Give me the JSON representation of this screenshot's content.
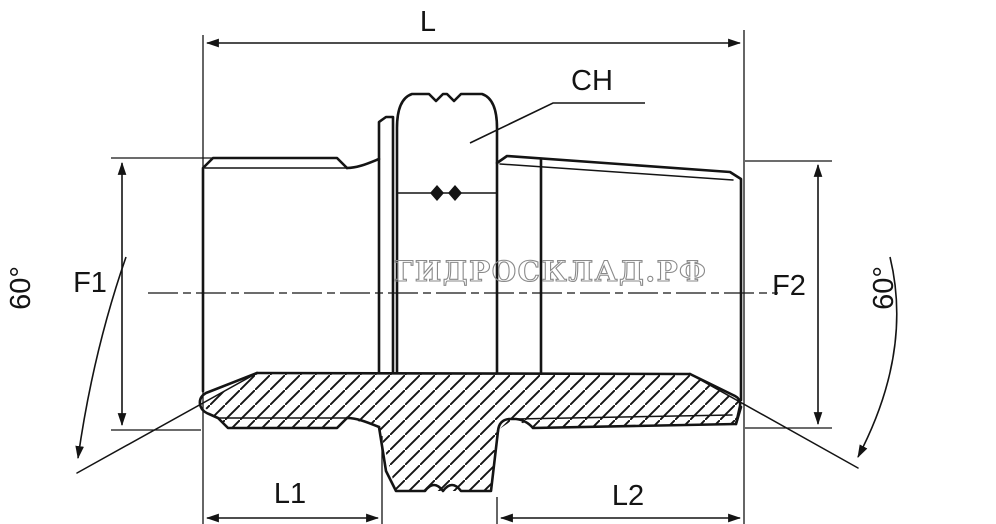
{
  "drawing": {
    "title": "straight male-male hydraulic adapter, dimensioned section drawing",
    "watermark": "ГИДРОСКЛАД.РФ",
    "colors": {
      "line": "#141414",
      "watermark_outline": "#8a8a8a",
      "background": "#ffffff"
    },
    "labels": {
      "overall_length": "L",
      "hex_across_flats": "CH",
      "thread_left_diameter": "F1",
      "thread_right_diameter": "F2",
      "thread_left_length": "L1",
      "thread_right_length": "L2",
      "cone_angle_left": "60°",
      "cone_angle_right": "60°"
    }
  }
}
